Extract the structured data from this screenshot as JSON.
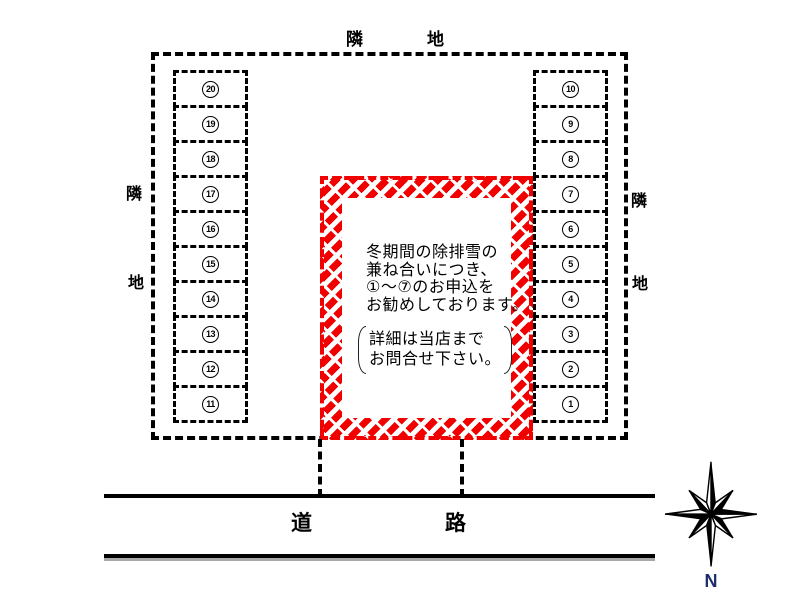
{
  "labels": {
    "adjacent_top": [
      "隣",
      "地"
    ],
    "adjacent_left": [
      "隣",
      "地"
    ],
    "adjacent_right": [
      "隣",
      "地"
    ],
    "road": [
      "道",
      "路"
    ],
    "compass_north": "N"
  },
  "parking": {
    "left_column_stalls": [
      "20",
      "19",
      "18",
      "17",
      "16",
      "15",
      "14",
      "13",
      "12",
      "11"
    ],
    "right_column_stalls": [
      "10",
      "9",
      "8",
      "7",
      "6",
      "5",
      "4",
      "3",
      "2",
      "1"
    ]
  },
  "notice": {
    "main_lines": [
      "冬期間の除排雪の",
      "兼ね合いにつき、",
      "①～⑦のお申込を",
      "お勧めしております。"
    ],
    "bracket_lines": [
      "詳細は当店まで",
      "お問合せ下さい。"
    ]
  },
  "colors": {
    "hatch_red": "#f20000",
    "boundary_black": "#000000",
    "north_label_blue": "#1c2f6b"
  }
}
